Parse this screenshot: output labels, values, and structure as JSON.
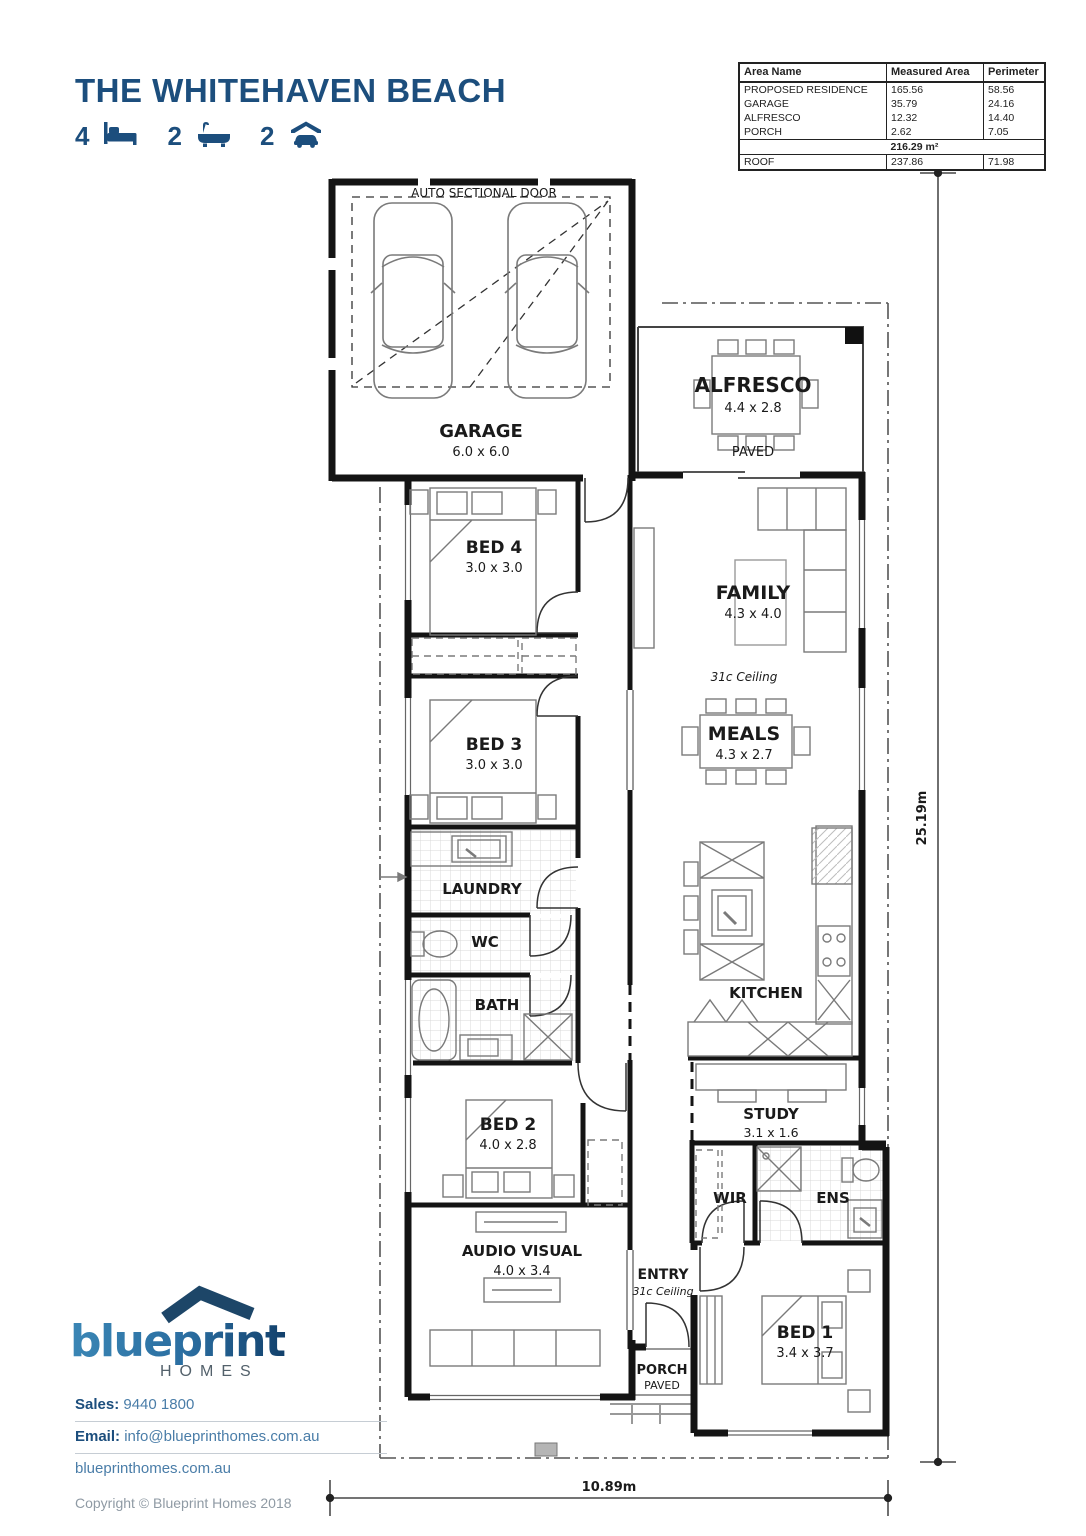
{
  "header": {
    "title": "THE WHITEHAVEN BEACH",
    "stats": {
      "beds": "4",
      "baths": "2",
      "cars": "2"
    }
  },
  "area_table": {
    "headers": [
      "Area Name",
      "Measured Area",
      "Perimeter"
    ],
    "rows": [
      {
        "name": "PROPOSED RESIDENCE",
        "area": "165.56",
        "perimeter": "58.56"
      },
      {
        "name": "GARAGE",
        "area": "35.79",
        "perimeter": "24.16"
      },
      {
        "name": "ALFRESCO",
        "area": "12.32",
        "perimeter": "14.40"
      },
      {
        "name": "PORCH",
        "area": "2.62",
        "perimeter": "7.05"
      }
    ],
    "total_area": "216.29 m²",
    "roof": {
      "name": "ROOF",
      "area": "237.86",
      "perimeter": "71.98"
    }
  },
  "plan": {
    "garage": {
      "label": "GARAGE",
      "size": "6.0 x 6.0",
      "door": "AUTO SECTIONAL DOOR"
    },
    "alfresco": {
      "label": "ALFRESCO",
      "size": "4.4 x 2.8",
      "note": "PAVED"
    },
    "bed4": {
      "label": "BED 4",
      "size": "3.0 x 3.0"
    },
    "family": {
      "label": "FAMILY",
      "size": "4.3 x 4.0",
      "ceiling": "31c Ceiling"
    },
    "bed3": {
      "label": "BED 3",
      "size": "3.0 x 3.0"
    },
    "meals": {
      "label": "MEALS",
      "size": "4.3 x 2.7"
    },
    "laundry": {
      "label": "LAUNDRY"
    },
    "wc": {
      "label": "WC"
    },
    "bath": {
      "label": "BATH"
    },
    "kitchen": {
      "label": "KITCHEN"
    },
    "bed2": {
      "label": "BED 2",
      "size": "4.0 x 2.8"
    },
    "study": {
      "label": "STUDY",
      "size": "3.1 x 1.6"
    },
    "wir": {
      "label": "WIR"
    },
    "ens": {
      "label": "ENS"
    },
    "audio_visual": {
      "label": "AUDIO VISUAL",
      "size": "4.0 x 3.4"
    },
    "entry": {
      "label": "ENTRY",
      "ceiling": "31c Ceiling"
    },
    "porch": {
      "label": "PORCH",
      "note": "PAVED"
    },
    "bed1": {
      "label": "BED 1",
      "size": "3.4 x 3.7"
    },
    "dimensions": {
      "height": "25.19m",
      "width": "10.89m"
    }
  },
  "footer": {
    "logo": {
      "text": "blueprint",
      "subtext": "HOMES"
    },
    "sales_label": "Sales:",
    "sales_value": "9440 1800",
    "email_label": "Email:",
    "email_value": "info@blueprinthomes.com.au",
    "website": "blueprinthomes.com.au",
    "copyright": "Copyright © Blueprint Homes 2018"
  },
  "colors": {
    "brand_navy": "#1c4e7d",
    "link_blue": "#4a7da8",
    "logo_gradient_start": "#3a86b5",
    "logo_gradient_end": "#12406b"
  }
}
